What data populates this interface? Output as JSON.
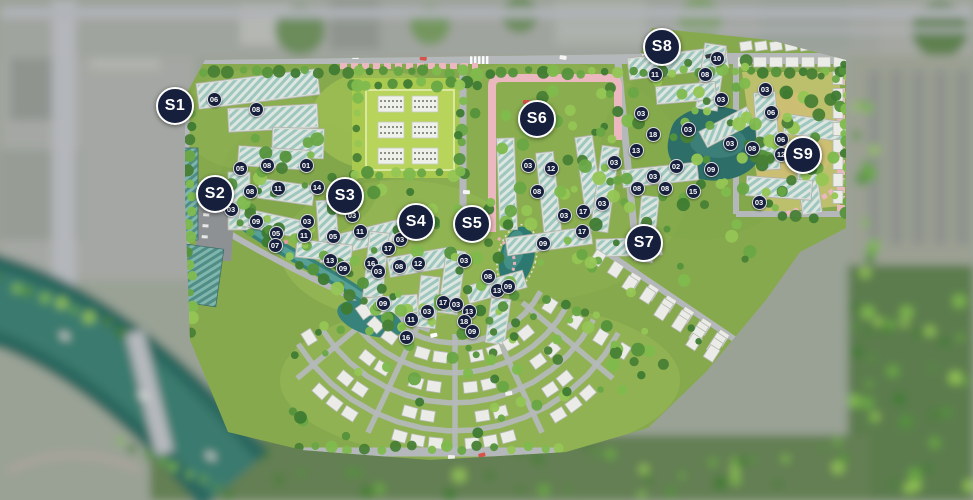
{
  "map": {
    "title": "residential-masterplan-aerial",
    "colors": {
      "marker_bg": "#161f3b",
      "marker_text": "#ffffff",
      "marker_ring": "#ffffff",
      "water": "#2f7a73",
      "lawn": "#a9c94f",
      "pink_path": "#eab8be"
    },
    "zones": [
      {
        "label": "S1",
        "x": 175,
        "y": 106
      },
      {
        "label": "S2",
        "x": 215,
        "y": 194
      },
      {
        "label": "S3",
        "x": 345,
        "y": 196
      },
      {
        "label": "S4",
        "x": 416,
        "y": 222
      },
      {
        "label": "S5",
        "x": 472,
        "y": 224
      },
      {
        "label": "S6",
        "x": 537,
        "y": 119
      },
      {
        "label": "S7",
        "x": 644,
        "y": 243
      },
      {
        "label": "S8",
        "x": 662,
        "y": 47
      },
      {
        "label": "S9",
        "x": 803,
        "y": 155
      }
    ],
    "buildings": [
      {
        "label": "06",
        "x": 214,
        "y": 99
      },
      {
        "label": "08",
        "x": 256,
        "y": 109
      },
      {
        "label": "05",
        "x": 240,
        "y": 168
      },
      {
        "label": "08",
        "x": 267,
        "y": 165
      },
      {
        "label": "01",
        "x": 306,
        "y": 165
      },
      {
        "label": "11",
        "x": 278,
        "y": 188
      },
      {
        "label": "14",
        "x": 317,
        "y": 187
      },
      {
        "label": "08",
        "x": 250,
        "y": 191
      },
      {
        "label": "03",
        "x": 231,
        "y": 209
      },
      {
        "label": "09",
        "x": 256,
        "y": 221
      },
      {
        "label": "05",
        "x": 276,
        "y": 233
      },
      {
        "label": "07",
        "x": 275,
        "y": 245
      },
      {
        "label": "03",
        "x": 307,
        "y": 221
      },
      {
        "label": "11",
        "x": 304,
        "y": 235
      },
      {
        "label": "05",
        "x": 333,
        "y": 236
      },
      {
        "label": "11",
        "x": 360,
        "y": 231
      },
      {
        "label": "03",
        "x": 352,
        "y": 215
      },
      {
        "label": "13",
        "x": 330,
        "y": 260
      },
      {
        "label": "09",
        "x": 343,
        "y": 268
      },
      {
        "label": "16",
        "x": 371,
        "y": 263
      },
      {
        "label": "03",
        "x": 378,
        "y": 271
      },
      {
        "label": "03",
        "x": 400,
        "y": 239
      },
      {
        "label": "17",
        "x": 388,
        "y": 248
      },
      {
        "label": "08",
        "x": 399,
        "y": 266
      },
      {
        "label": "12",
        "x": 418,
        "y": 263
      },
      {
        "label": "09",
        "x": 383,
        "y": 303
      },
      {
        "label": "11",
        "x": 411,
        "y": 319
      },
      {
        "label": "16",
        "x": 406,
        "y": 337
      },
      {
        "label": "03",
        "x": 427,
        "y": 311
      },
      {
        "label": "17",
        "x": 443,
        "y": 302
      },
      {
        "label": "03",
        "x": 456,
        "y": 304
      },
      {
        "label": "13",
        "x": 469,
        "y": 311
      },
      {
        "label": "18",
        "x": 464,
        "y": 321
      },
      {
        "label": "09",
        "x": 472,
        "y": 331
      },
      {
        "label": "03",
        "x": 464,
        "y": 260
      },
      {
        "label": "08",
        "x": 488,
        "y": 276
      },
      {
        "label": "13",
        "x": 497,
        "y": 290
      },
      {
        "label": "09",
        "x": 508,
        "y": 286
      },
      {
        "label": "03",
        "x": 528,
        "y": 165
      },
      {
        "label": "12",
        "x": 551,
        "y": 168
      },
      {
        "label": "08",
        "x": 537,
        "y": 191
      },
      {
        "label": "09",
        "x": 543,
        "y": 243
      },
      {
        "label": "03",
        "x": 564,
        "y": 215
      },
      {
        "label": "17",
        "x": 583,
        "y": 211
      },
      {
        "label": "17",
        "x": 582,
        "y": 231
      },
      {
        "label": "03",
        "x": 602,
        "y": 203
      },
      {
        "label": "03",
        "x": 614,
        "y": 162
      },
      {
        "label": "13",
        "x": 636,
        "y": 150
      },
      {
        "label": "18",
        "x": 653,
        "y": 134
      },
      {
        "label": "03",
        "x": 641,
        "y": 113
      },
      {
        "label": "11",
        "x": 655,
        "y": 74
      },
      {
        "label": "08",
        "x": 705,
        "y": 74
      },
      {
        "label": "10",
        "x": 717,
        "y": 58
      },
      {
        "label": "03",
        "x": 688,
        "y": 129
      },
      {
        "label": "02",
        "x": 676,
        "y": 166
      },
      {
        "label": "03",
        "x": 653,
        "y": 176
      },
      {
        "label": "08",
        "x": 637,
        "y": 188
      },
      {
        "label": "08",
        "x": 665,
        "y": 188
      },
      {
        "label": "15",
        "x": 693,
        "y": 191
      },
      {
        "label": "09",
        "x": 711,
        "y": 169
      },
      {
        "label": "03",
        "x": 765,
        "y": 89
      },
      {
        "label": "03",
        "x": 721,
        "y": 99
      },
      {
        "label": "06",
        "x": 771,
        "y": 112
      },
      {
        "label": "03",
        "x": 730,
        "y": 143
      },
      {
        "label": "08",
        "x": 752,
        "y": 148
      },
      {
        "label": "06",
        "x": 781,
        "y": 139
      },
      {
        "label": "12",
        "x": 781,
        "y": 154
      },
      {
        "label": "03",
        "x": 759,
        "y": 202
      }
    ]
  }
}
